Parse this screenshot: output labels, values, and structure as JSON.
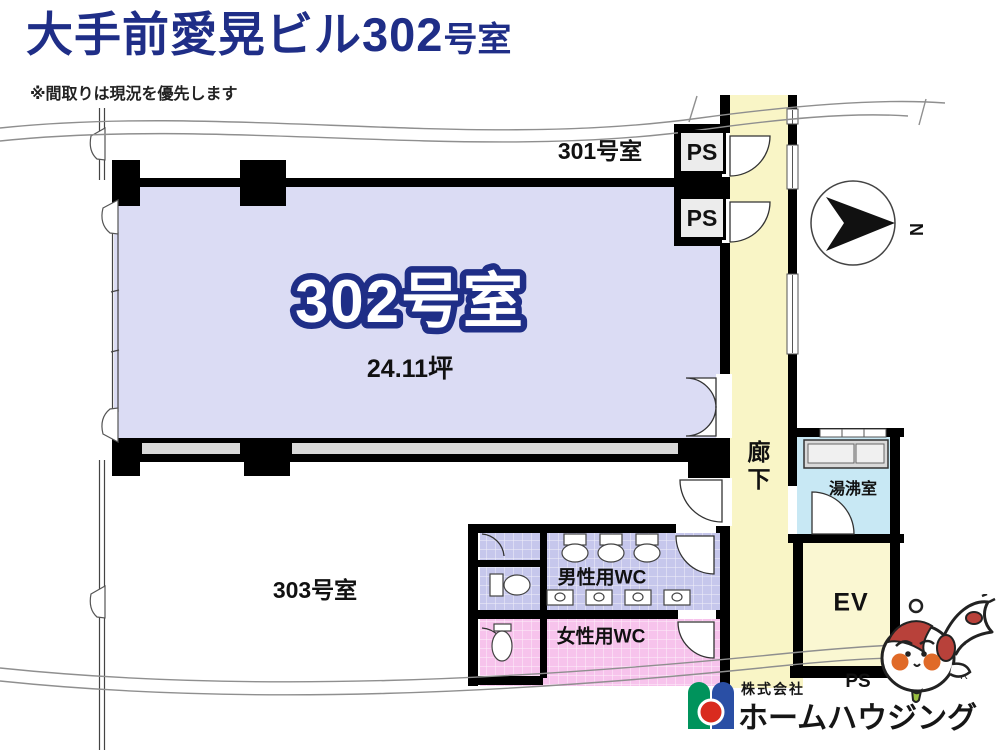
{
  "header": {
    "title_main": "大手前愛晃ビル302",
    "title_suffix": "号室",
    "note": "※間取りは現況を優先します"
  },
  "rooms": {
    "room301": {
      "label": "301号室"
    },
    "room302": {
      "label": "302号室",
      "area": "24.11坪"
    },
    "room303": {
      "label": "303号室"
    },
    "corridor": {
      "label": "廊下"
    },
    "kitchenette": {
      "label": "湯沸室"
    },
    "elevator": {
      "label": "EV"
    },
    "mens_wc": {
      "label": "男性用WC"
    },
    "womens_wc": {
      "label": "女性用WC"
    },
    "pipe_space_1": {
      "label": "PS"
    },
    "pipe_space_2": {
      "label": "PS"
    },
    "pipe_space_3": {
      "label": "PS"
    }
  },
  "compass": {
    "north_label": "N"
  },
  "logo": {
    "company_prefix": "株式会社",
    "company_name": "ホームハウジング",
    "registered_mark": "R"
  },
  "colors": {
    "title": "#1f2e87",
    "room_302_fill": "#dbdcf4",
    "corridor_fill": "#f9f5c6",
    "kitchenette_fill": "#c8e8f4",
    "elevator_fill": "#faf7d2",
    "mens_wc_fill": "#c6c7ec",
    "womens_wc_fill": "#f7c3ec",
    "wall": "#000000",
    "logo_green": "#00935c",
    "logo_blue": "#2a4fa5",
    "logo_red": "#d92b1f"
  }
}
